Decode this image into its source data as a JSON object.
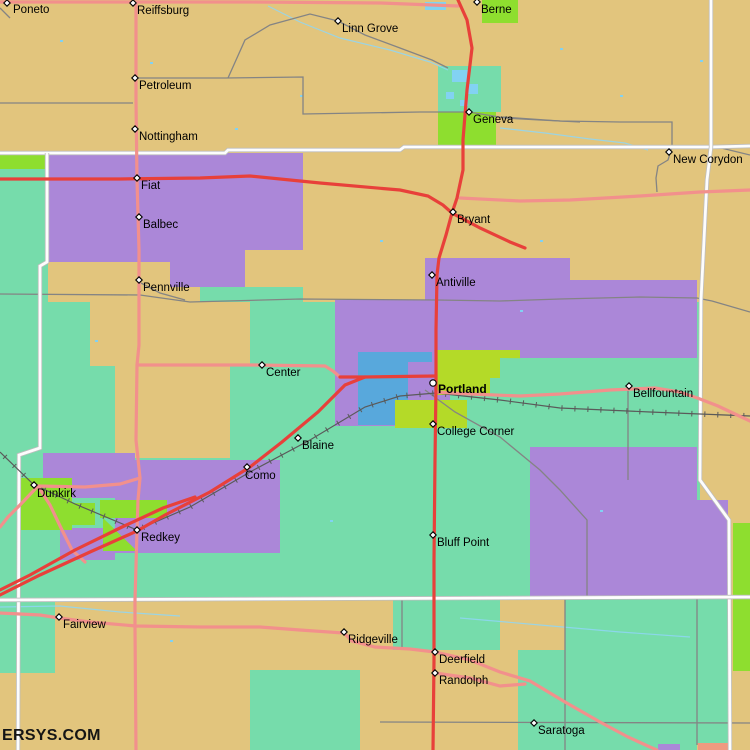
{
  "site": {
    "watermark": "ERSYS.COM"
  },
  "map": {
    "palette": {
      "land_tan": "#e2c57d",
      "city_purple": "#ab87d8",
      "city_teal": "#76dcab",
      "city_green": "#8ede2f",
      "city_yellow_green": "#b4da28",
      "urban_blue": "#58a8dc",
      "water_blue": "#82d2f2",
      "road_red": "#e8403a",
      "road_pink": "#f2908c",
      "road_white": "#fdfdfd",
      "road_gray": "#848484",
      "railroad": "#5a5a5a",
      "label_color": "#000000"
    },
    "towns": [
      {
        "name": "Poneto",
        "x": 7,
        "y": 3,
        "dx": 6,
        "dy": 10
      },
      {
        "name": "Reiffsburg",
        "x": 133,
        "y": 3,
        "dx": 4,
        "dy": 11
      },
      {
        "name": "Linn Grove",
        "x": 338,
        "y": 21,
        "dx": 4,
        "dy": 11
      },
      {
        "name": "Berne",
        "x": 477,
        "y": 2,
        "dx": 4,
        "dy": 11
      },
      {
        "name": "Petroleum",
        "x": 135,
        "y": 78,
        "dx": 4,
        "dy": 11
      },
      {
        "name": "Nottingham",
        "x": 135,
        "y": 129,
        "dx": 4,
        "dy": 11
      },
      {
        "name": "Geneva",
        "x": 469,
        "y": 112,
        "dx": 4,
        "dy": 11
      },
      {
        "name": "New Corydon",
        "x": 669,
        "y": 152,
        "dx": 4,
        "dy": 11
      },
      {
        "name": "Fiat",
        "x": 137,
        "y": 178,
        "dx": 4,
        "dy": 11
      },
      {
        "name": "Balbec",
        "x": 139,
        "y": 217,
        "dx": 4,
        "dy": 11
      },
      {
        "name": "Bryant",
        "x": 453,
        "y": 212,
        "dx": 4,
        "dy": 11
      },
      {
        "name": "Pennville",
        "x": 139,
        "y": 280,
        "dx": 4,
        "dy": 11
      },
      {
        "name": "Antiville",
        "x": 432,
        "y": 275,
        "dx": 4,
        "dy": 11
      },
      {
        "name": "Center",
        "x": 262,
        "y": 365,
        "dx": 4,
        "dy": 11
      },
      {
        "name": "Portland",
        "x": 433,
        "y": 383,
        "dx": 5,
        "dy": 10,
        "bold": true,
        "marker": "circle"
      },
      {
        "name": "Bellfountain",
        "x": 629,
        "y": 386,
        "dx": 4,
        "dy": 11
      },
      {
        "name": "College Corner",
        "x": 433,
        "y": 424,
        "dx": 4,
        "dy": 11
      },
      {
        "name": "Blaine",
        "x": 298,
        "y": 438,
        "dx": 4,
        "dy": 11
      },
      {
        "name": "Como",
        "x": 247,
        "y": 467,
        "dx": -2,
        "dy": 12
      },
      {
        "name": "Dunkirk",
        "x": 34,
        "y": 485,
        "dx": 3,
        "dy": 12
      },
      {
        "name": "Redkey",
        "x": 137,
        "y": 530,
        "dx": 4,
        "dy": 11
      },
      {
        "name": "Bluff Point",
        "x": 433,
        "y": 535,
        "dx": 4,
        "dy": 11
      },
      {
        "name": "Fairview",
        "x": 59,
        "y": 617,
        "dx": 4,
        "dy": 11
      },
      {
        "name": "Ridgeville",
        "x": 344,
        "y": 632,
        "dx": 4,
        "dy": 11
      },
      {
        "name": "Deerfield",
        "x": 435,
        "y": 652,
        "dx": 4,
        "dy": 11
      },
      {
        "name": "Randolph",
        "x": 435,
        "y": 673,
        "dx": 4,
        "dy": 11
      },
      {
        "name": "Saratoga",
        "x": 534,
        "y": 723,
        "dx": 4,
        "dy": 11
      }
    ]
  }
}
